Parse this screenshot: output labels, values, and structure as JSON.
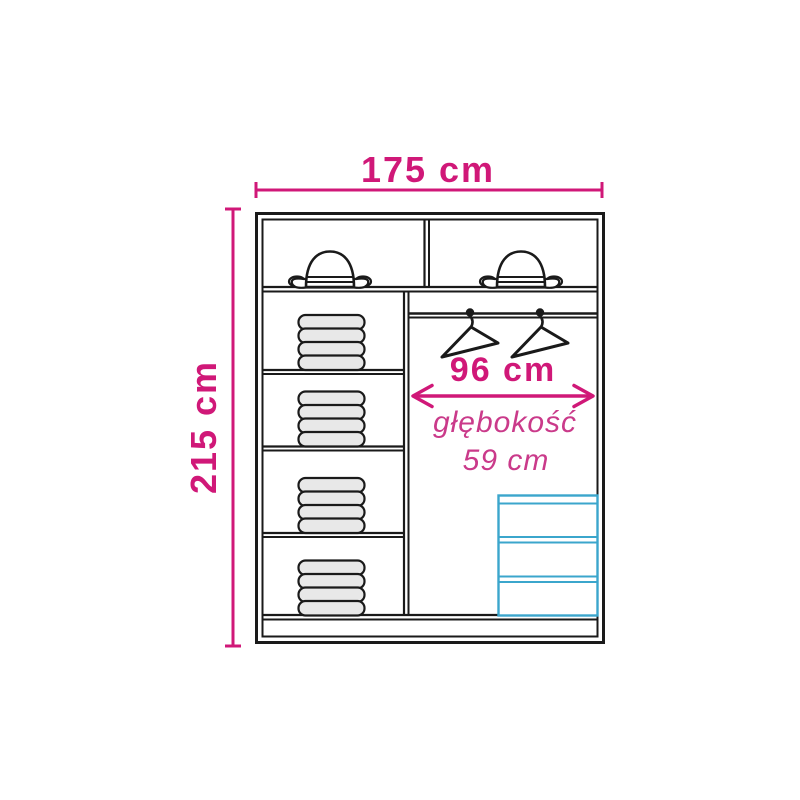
{
  "diagram": {
    "dimensions": {
      "width_label": "175 cm",
      "height_label": "215 cm",
      "interior_width_label": "96 cm",
      "depth_label": "głębokość",
      "depth_value": "59 cm"
    },
    "colors": {
      "pink": "#d01878",
      "pink_light": "#ca3a8a",
      "cyan": "#3ba6cc",
      "ink": "#1a1a1a",
      "gray": "#e8e8e8"
    },
    "icons": [
      "bowler-hat-icon",
      "hanger-icon",
      "clothes-stack-icon",
      "drawer-unit-icon"
    ]
  }
}
